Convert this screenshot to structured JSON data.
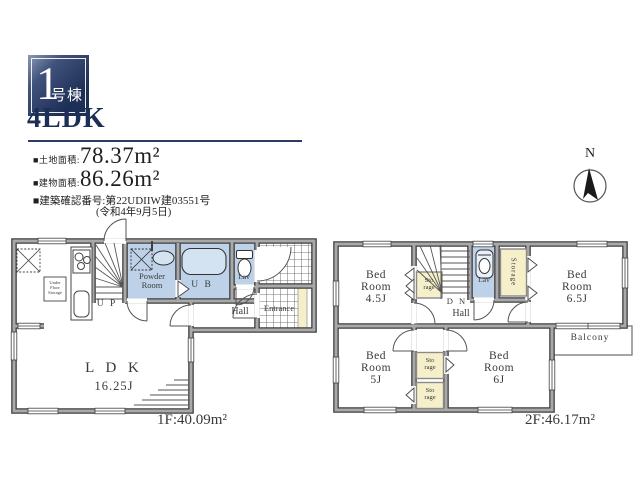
{
  "colors": {
    "accent_navy": "#1d2f55",
    "room_blue": "#bdd2e9",
    "storage_yellow": "#f5f0c9",
    "wall_gray": "#a9a9a9"
  },
  "header": {
    "badge": {
      "number": "1",
      "suffix": "号棟"
    },
    "plan_type": "4LDK",
    "land": {
      "label": "■土地面積:",
      "value": "78.37m²"
    },
    "building": {
      "label": "■建物面積:",
      "value": "86.26m²"
    },
    "approval": {
      "label": "■建築確認番号:",
      "number": "第22UDIIW建03551号",
      "date": "(令和4年9月5日)"
    },
    "compass_n": "N"
  },
  "floor1": {
    "area_label": "1F:40.09m²",
    "labels": {
      "ldk": "L D K",
      "ldk_size": "16.25J",
      "powder_1": "Powder",
      "powder_2": "Room",
      "ub": "U B",
      "lav": "Lav",
      "up": "U P",
      "hall": "Hall",
      "entrance": "Entrance",
      "under_floor_1": "Under",
      "under_floor_2": "Floor",
      "under_floor_3": "Storage"
    }
  },
  "floor2": {
    "area_label": "2F:46.17m²",
    "labels": {
      "bed1_1": "Bed",
      "bed1_2": "Room",
      "bed1_3": "4.5J",
      "bed2_1": "Bed",
      "bed2_2": "Room",
      "bed2_3": "6.5J",
      "bed3_1": "Bed",
      "bed3_2": "Room",
      "bed3_3": "5J",
      "bed4_1": "Bed",
      "bed4_2": "Room",
      "bed4_3": "6J",
      "sto_a_1": "Sto",
      "sto_a_2": "rage",
      "sto_b_1": "Sto",
      "sto_b_2": "rage",
      "sto_c_1": "Sto",
      "sto_c_2": "rage",
      "storage_vert": "Storage",
      "lav": "Lav",
      "dn": "D N",
      "hall": "Hall",
      "balcony": "Balcony"
    }
  }
}
